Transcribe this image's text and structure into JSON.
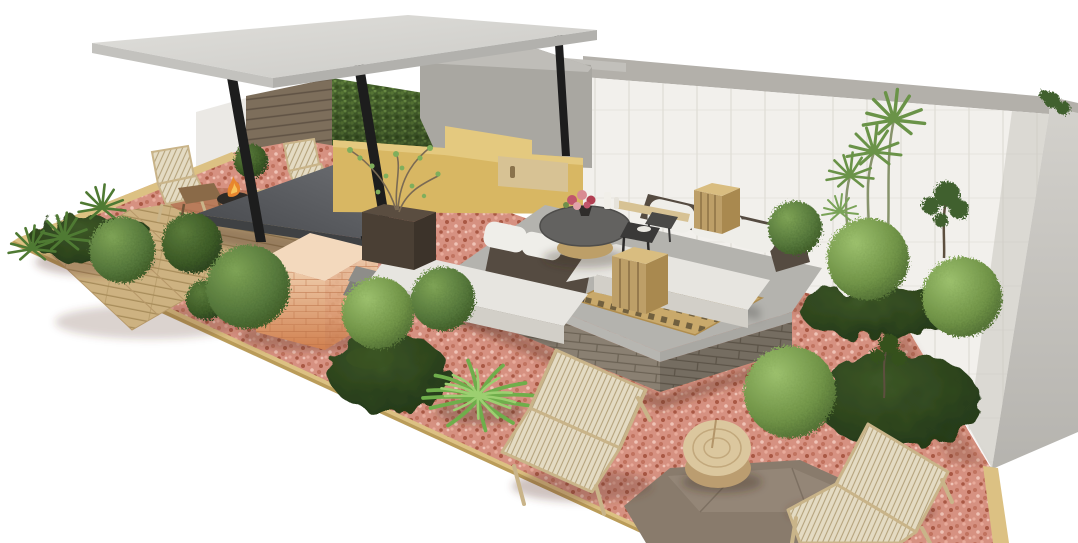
{
  "meta": {
    "title": "3D landscape design render of a long rooftop terrace garden",
    "render_type": "architectural 3d visualization",
    "background": "#ffffff"
  },
  "palette": {
    "bg": "#ffffff",
    "roofTop": "#d9d8d4",
    "roofEdge": "#c3c2be",
    "roofSide": "#b2b1ad",
    "column": "#1d1d1d",
    "coping": "#b3b0aa",
    "wallFace": "#f2f0ec",
    "wallLine": "#dfdcd5",
    "grayWall": "#a9a7a1",
    "grayWallLight": "#c2c0bb",
    "woodWall": "#7d6e5b",
    "woodWallLine": "#5f5244",
    "hedgeBase": "#47632e",
    "yellowWall": "#d8b763",
    "yellowLight": "#e4c97f",
    "woodBox": "#d7c294",
    "gravelBase": "#d69181",
    "border": "#dcc183",
    "borderDark": "#b2924f",
    "deckWood": "#cdb281",
    "deckLine": "#a78c5a",
    "floorGray": "#a5a4a0",
    "tableSide": "#3f4143",
    "chairWood": "#c9b489",
    "mesh": "#e4dbc3",
    "meshLine": "#b5a37c",
    "fire": "#e8862e",
    "fireDark": "#2e2a26",
    "stoneBase": "#8a8072",
    "stoneLine": "#6b6254",
    "slabGray": "#b7b6b1",
    "lattice": "#c9a96b",
    "latticeHole": "#71603f",
    "sofaWhite": "#e7e5e0",
    "sofaShade": "#d2cfc8",
    "wovenDark": "#554b41",
    "coffeeTop": "#636260",
    "rattan": "#bd9f68",
    "sideTable": "#3a3938",
    "mossDark": "#27391b",
    "stoneSlab": "#897b6c",
    "logTop": "#dbc79e",
    "logSide": "#bb9d70",
    "logRing": "#c2a87c",
    "bushLight": "#8cb061",
    "bushMid": "#5f8140",
    "bushDark": "#3c5526",
    "agaveGreen": "#6fae4b",
    "agaveLightGreen": "#9ccf70",
    "terracottaLight": "#f2d4b4",
    "terracottaDark": "#d07f4e"
  },
  "scene": {
    "objects": [
      {
        "name": "pergola-roof",
        "description": "flat concrete roof slab on slanted black steel columns"
      },
      {
        "name": "wood-slat-wall",
        "description": "horizontal timber plank wall under pergola"
      },
      {
        "name": "green-hedge-wall",
        "description": "vertical garden hedge panel"
      },
      {
        "name": "concrete-back-wall",
        "description": "tall grey concrete wall of pavilion"
      },
      {
        "name": "perimeter-wall",
        "description": "white tiled boundary wall with grey coping running to far corner"
      },
      {
        "name": "yellow-parapet",
        "description": "mustard yellow low wall behind sofa with timber cabinet"
      },
      {
        "name": "dining-table",
        "description": "long dark grey stone dining table with woven wood chairs"
      },
      {
        "name": "fire-pit",
        "description": "small fire bowl with flames near lounge chairs"
      },
      {
        "name": "deck-steps",
        "description": "wooden deck with three descending plank steps"
      },
      {
        "name": "terracotta-block",
        "description": "gradient terracotta brick bar block"
      },
      {
        "name": "lounge-platform",
        "description": "concrete platform on stacked stone base with timber lattice tiles"
      },
      {
        "name": "sectional-sofa",
        "description": "L-shaped white cushion sofa with dark woven backrests"
      },
      {
        "name": "coffee-table",
        "description": "round dark table on rattan drum base with flowers and candles"
      },
      {
        "name": "rattan-lanterns",
        "description": "two woven box lanterns"
      },
      {
        "name": "planter-tree",
        "description": "dark planter box with small airy tree"
      },
      {
        "name": "boxwood-balls",
        "description": "many clipped green ball shrubs across pink gravel"
      },
      {
        "name": "moss-mounds",
        "description": "dark green ground-cover mounds"
      },
      {
        "name": "agave-plant",
        "description": "spiky bright green agave rosette"
      },
      {
        "name": "dracaena-stems",
        "description": "tall thin stems with spiky tufts against white wall"
      },
      {
        "name": "pink-gravel-bed",
        "description": "long diagonal bed of crushed pink gravel with timber edge"
      },
      {
        "name": "stone-slab",
        "description": "large flat grey stepping stone in foreground"
      },
      {
        "name": "log-side-table",
        "description": "round timber log coffee table"
      },
      {
        "name": "rope-lounge-chairs",
        "description": "two light timber lounge chairs with woven rope mesh"
      }
    ]
  }
}
